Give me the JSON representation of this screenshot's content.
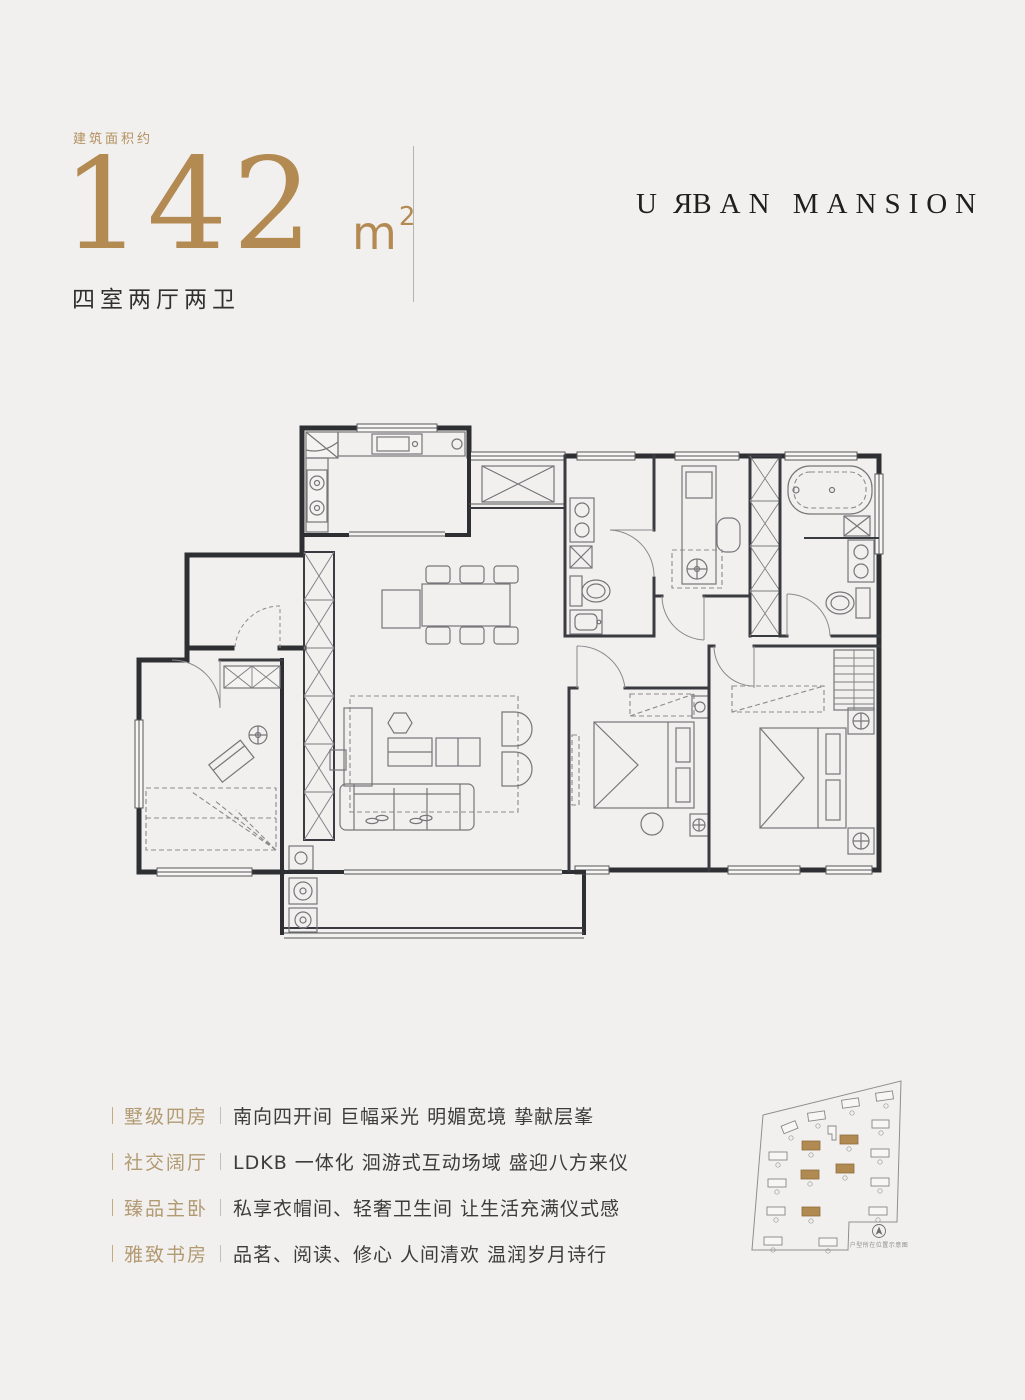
{
  "colors": {
    "background": "#f1f0ee",
    "gold_accent": "#b28a52",
    "feature_label_gold": "#b29a72",
    "dark_text": "#3c3c3c",
    "brand_text": "#1f1f1f",
    "plan_wall": "#2e2f33",
    "siteplan_highlight": "#b08a50"
  },
  "header": {
    "area_label": "建筑面积约",
    "area_value": "142",
    "area_unit_base": "m",
    "area_unit_sup": "2",
    "layout_text": "四室两厅两卫",
    "brand_parts": {
      "pre": "U",
      "mirrored": "R",
      "post": "BAN MANSION"
    }
  },
  "features": [
    {
      "label": "墅级四房",
      "text": "南向四开间  巨幅采光  明媚宽境  挚献层峯"
    },
    {
      "label": "社交阔厅",
      "text": "LDKB 一体化  洄游式互动场域  盛迎八方来仪"
    },
    {
      "label": "臻品主卧",
      "text": "私享衣帽间、轻奢卫生间  让生活充满仪式感"
    },
    {
      "label": "雅致书房",
      "text": "品茗、阅读、修心  人间清欢  温润岁月诗行"
    }
  ],
  "site_plan": {
    "caption": "户型所在位置示意图",
    "buildings_total": 19,
    "buildings_highlighted": 5
  }
}
